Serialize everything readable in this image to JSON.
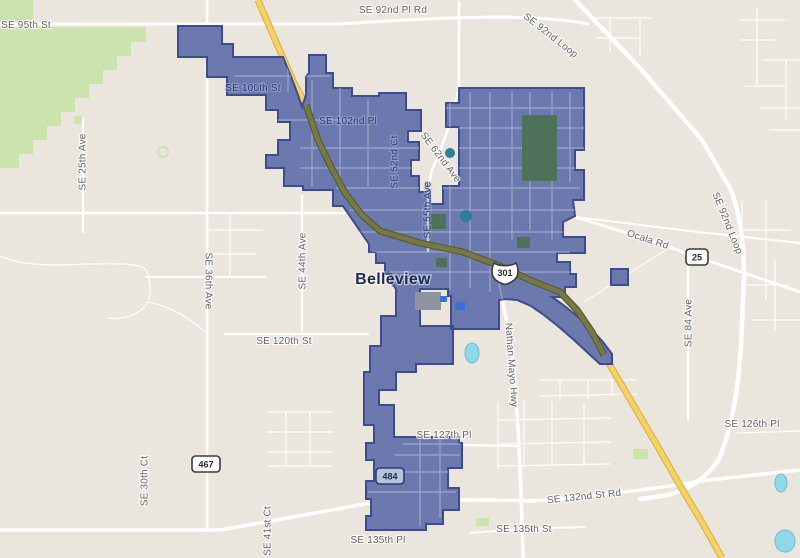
{
  "map": {
    "city_label": "Belleview",
    "boundary_feature": "Belleview city boundary",
    "labels": {
      "se_95th_st": "SE 95th St",
      "se_92nd_pl_rd": "SE 92nd Pl Rd",
      "se_92nd_loop_a": "SE 92nd Loop",
      "se_92nd_loop_b": "SE 92nd Loop",
      "se_100th_st": "SE 100th St",
      "se_102nd_pl": "SE 102nd Pl",
      "se_52nd_ct": "SE 52nd Ct",
      "se_62nd_ave": "SE 62nd Ave",
      "se_55th_ave": "SE 55th Ave",
      "se_25th_ave": "SE 25th Ave",
      "se_36th_ave": "SE 36th Ave",
      "se_44th_ave": "SE 44th Ave",
      "se_120th_st": "SE 120th St",
      "nathan_mayo_hwy": "Nathan Mayo Hwy",
      "ocala_rd": "Ocala Rd",
      "se_84_ave": "SE 84 Ave",
      "se_126th_pl": "SE 126th Pl",
      "se_132nd_st_rd": "SE 132nd St Rd",
      "se_127th_pl": "SE 127th Pl",
      "se_135th_pl": "SE 135th Pl",
      "se_135th_st": "SE 135th St",
      "se_30th_ct": "SE 30th Ct",
      "se_41st_ct": "SE 41st Ct"
    },
    "shields": {
      "us_301": "301",
      "sr_25": "25",
      "sr_467": "467",
      "sr_484": "484"
    },
    "colors": {
      "background": "#eae6dd",
      "city_fill": "#6b79ae",
      "city_border": "#3e4c8f",
      "highway_yellow": "#f5d263",
      "highway_casing": "#dcb64d",
      "highway_olive": "#767947",
      "olive_casing": "#5a5c33",
      "road_white": "#ffffff",
      "forest_green": "#cbe3ad",
      "park_dark_green": "#4e7259",
      "water_blue": "#8fd9ea",
      "building_gray": "#8e95a0",
      "poi_blue": "#3b70dd",
      "pond_teal": "#2e7e99",
      "street_inside": "#9aa4c8",
      "street_inside_bright": "#ccd3e8",
      "label_gray": "#636363",
      "label_navy": "#2c3b6f",
      "city_label_navy": "#1c2b52",
      "shield_tint": "#b9c2db"
    }
  }
}
